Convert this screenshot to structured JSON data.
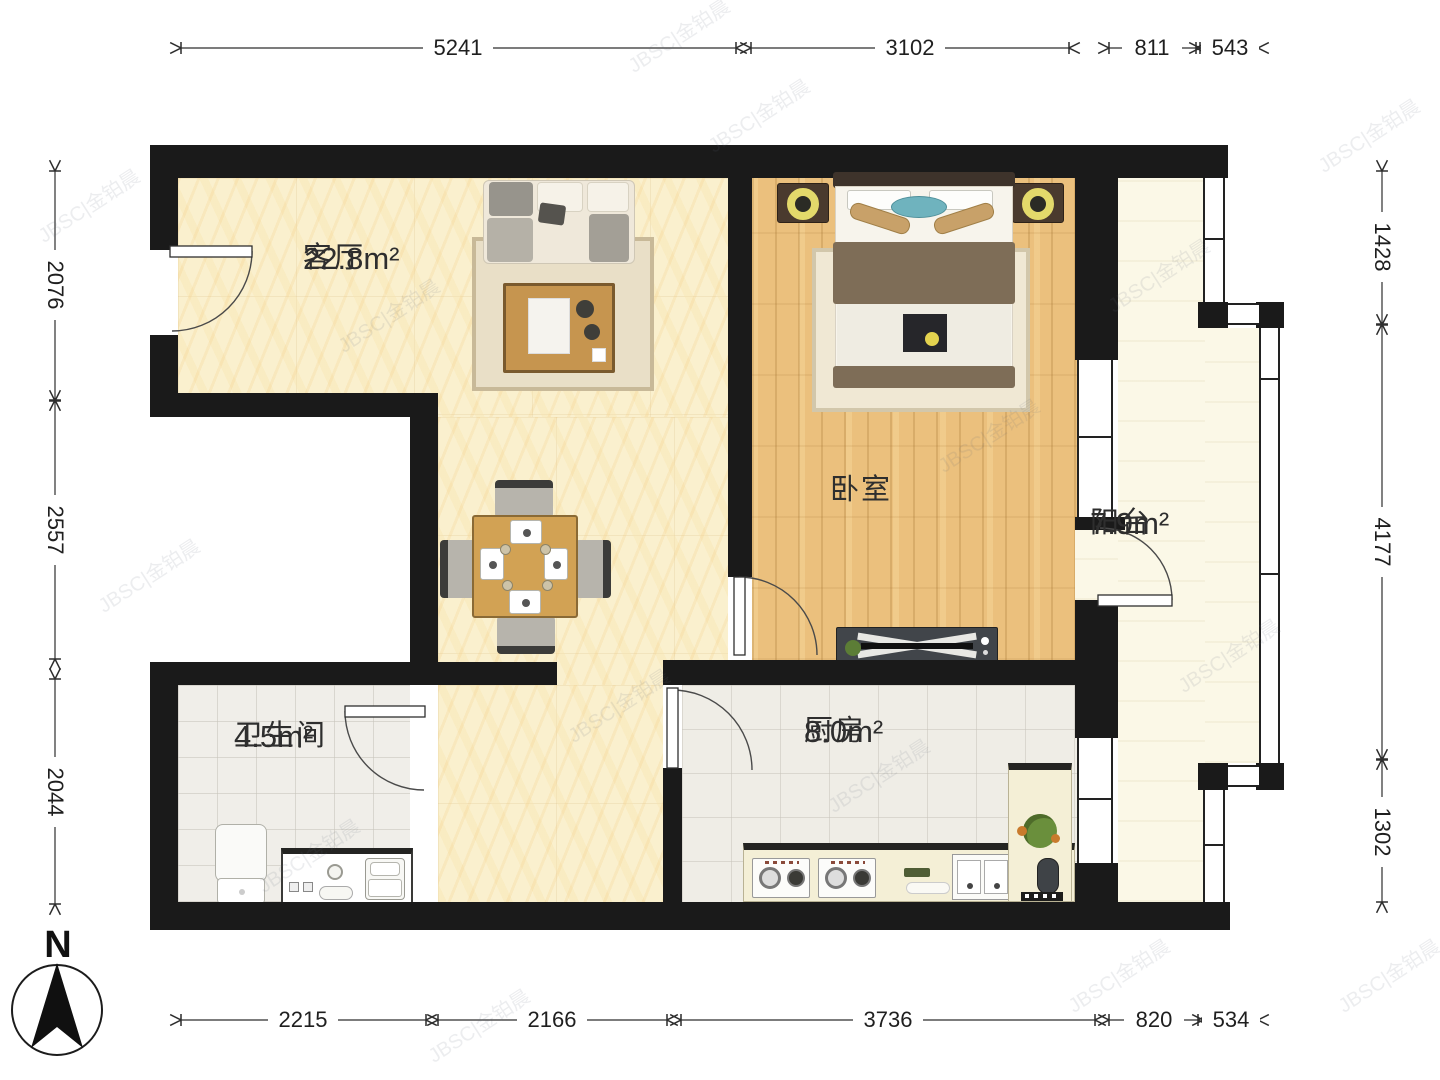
{
  "compass": {
    "label": "N"
  },
  "rooms": {
    "living": {
      "name": "客厅",
      "area": "22.8m²"
    },
    "bedroom": {
      "name": "卧室",
      "area": ""
    },
    "balcony": {
      "name": "阳台",
      "area": "7.9m²"
    },
    "bathroom": {
      "name": "卫生间",
      "area": "4.5m²"
    },
    "kitchen": {
      "name": "厨房",
      "area": "8.0m²"
    }
  },
  "dimensions": {
    "top": [
      "5241",
      "3102",
      "811",
      "543"
    ],
    "bottom": [
      "2215",
      "2166",
      "3736",
      "820",
      "534"
    ],
    "left": [
      "2076",
      "2557",
      "2044"
    ],
    "right": [
      "1428",
      "4177",
      "1302"
    ]
  },
  "watermark": "JBSC|金铂晨",
  "colors": {
    "wall": "#1a1a1a",
    "living_floor": "#FAF0CE",
    "bedroom_floor": "#EBC07D",
    "balcony_floor": "#FBF8E7",
    "bathroom_floor": "#F0EEE9",
    "kitchen_floor": "#EFEDE6",
    "dimension_text": "#1f1f1f"
  }
}
